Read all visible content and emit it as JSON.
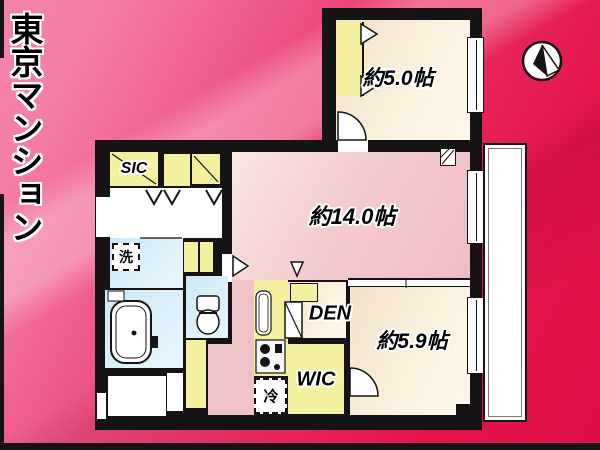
{
  "banner": {
    "title": "東京マンション"
  },
  "compass": {
    "description": "north-arrow"
  },
  "rooms": {
    "bedroom_small": {
      "label": "約5.0帖"
    },
    "ldk": {
      "label": "約14.0帖"
    },
    "bedroom_medium": {
      "label": "約5.9帖"
    },
    "den": {
      "label": "DEN"
    },
    "wic": {
      "label": "WIC"
    },
    "sic": {
      "label": "SIC"
    },
    "laundry": {
      "label": "洗"
    },
    "refrigerator": {
      "label": "冷"
    }
  },
  "colors": {
    "background_red": "#e6174a",
    "background_pink": "#f47fa6",
    "wall_black": "#151313",
    "floor_cream": "#f9eedd",
    "floor_pink": "#f2c9cd",
    "closet_yellow": "#f5efa0",
    "wet_area_blue": "#d9effa",
    "balcony_white": "#ffffff"
  }
}
